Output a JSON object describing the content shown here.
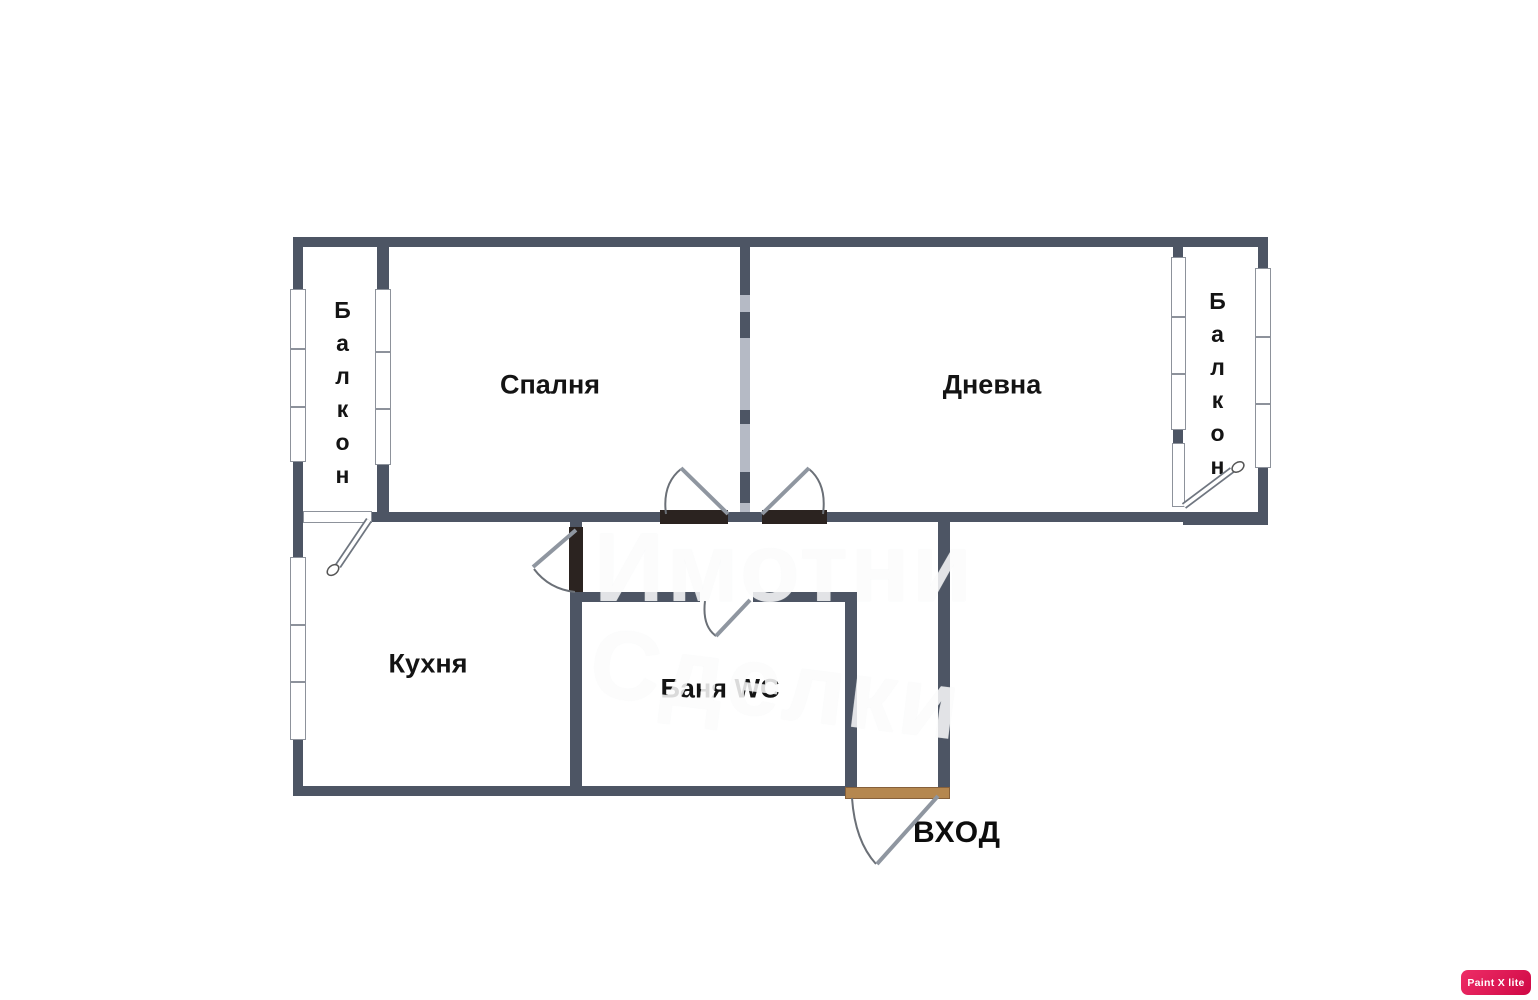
{
  "rooms": {
    "bedroom": "Спалня",
    "living": "Дневна",
    "kitchen": "Кухня",
    "bath": "Баня WC",
    "entrance": "ВХОД",
    "balcony_left": "Балкон",
    "balcony_right": "Балкон"
  },
  "watermark": {
    "line1": "Имотни",
    "line2": "Сделки"
  },
  "badge": "Paint X lite",
  "colors": {
    "wall": "#4d5564",
    "wall_faded": "#b5bac5",
    "door_threshold": "#2b2320",
    "entrance_threshold": "#b5874f",
    "badge_bg": "#d91a57",
    "label": "#141414",
    "watermark": "#ffffff"
  }
}
